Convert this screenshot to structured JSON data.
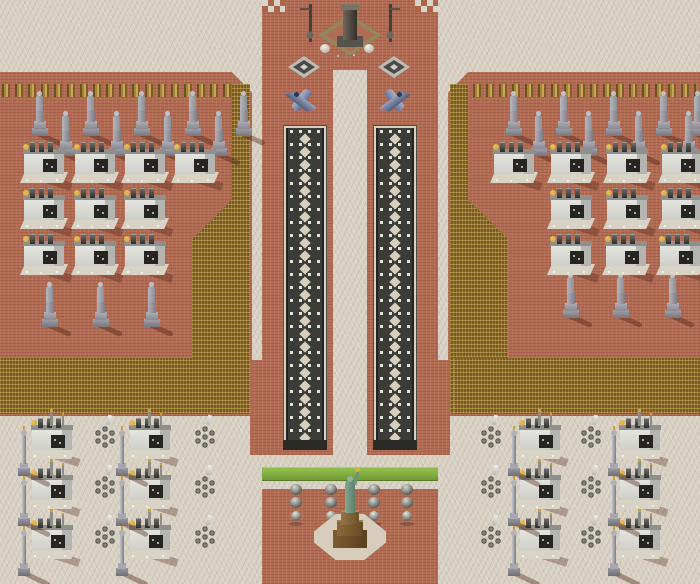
{
  "scene": {
    "kind": "isometric-rts-map",
    "width": 700,
    "height": 584
  },
  "palette": {
    "sand": "#d8d0c2",
    "brick": "#b06c55",
    "gold": "#8a6c2e",
    "track": "#3b3b37",
    "trackLight": "#e4e4de",
    "grass": "#6f9a34",
    "grassLight": "#95c050",
    "checkerRed": "#ad6449",
    "checkerWhite": "#d8d4cc",
    "statueGrey": "#9b99a1",
    "buildingWhite": "#e6e6e2",
    "libertyGreen": "#5a7e6a",
    "pedestalBrown": "#7c5c32",
    "jetBlue": "#667094",
    "goldDome": "#d2a032"
  },
  "terrain": [
    {
      "name": "sand-ground",
      "cls": "sand",
      "x": 0,
      "y": 0,
      "w": 700,
      "h": 584
    },
    {
      "name": "left-terrace",
      "cls": "red",
      "x": 0,
      "y": 72,
      "w": 252,
      "h": 344,
      "clip": "polygon(0 0, 92% 0, 100% 6%, 100% 100%, 0 100%)"
    },
    {
      "name": "right-terrace",
      "cls": "red",
      "x": 448,
      "y": 72,
      "w": 252,
      "h": 344,
      "clip": "polygon(8% 0, 100% 0, 100% 100%, 0 100%, 0 6%)"
    },
    {
      "name": "center-corridor",
      "cls": "red",
      "x": 262,
      "y": 0,
      "w": 176,
      "h": 455
    },
    {
      "name": "corridor-bridge-left",
      "cls": "red",
      "x": 250,
      "y": 360,
      "w": 12,
      "h": 95
    },
    {
      "name": "corridor-bridge-right",
      "cls": "red",
      "x": 438,
      "y": 360,
      "w": 12,
      "h": 95
    },
    {
      "name": "plaza-checker-left",
      "cls": "checker",
      "x": 262,
      "y": 0,
      "w": 23,
      "h": 12
    },
    {
      "name": "plaza-checker-right",
      "cls": "checker",
      "x": 415,
      "y": 0,
      "w": 23,
      "h": 12
    },
    {
      "name": "gold-row-left",
      "cls": "goldrow",
      "x": 2,
      "y": 84,
      "w": 240,
      "h": 13
    },
    {
      "name": "gold-band-left",
      "cls": "gold",
      "x": 192,
      "y": 84,
      "w": 58,
      "h": 330,
      "clip": "polygon(69% 0,100% 0,100% 100%,0 100%,0 47%,69% 35%)"
    },
    {
      "name": "gold-band-left-bottom",
      "cls": "gold",
      "x": 0,
      "y": 358,
      "w": 246,
      "h": 56
    },
    {
      "name": "gold-row-right",
      "cls": "goldrow",
      "x": 460,
      "y": 84,
      "w": 238,
      "h": 13
    },
    {
      "name": "gold-band-right",
      "cls": "gold",
      "x": 450,
      "y": 84,
      "w": 58,
      "h": 330,
      "clip": "polygon(0 0,31% 0,31% 35%,100% 47%,100% 100%,0 100%)"
    },
    {
      "name": "gold-band-right-bottom",
      "cls": "gold",
      "x": 454,
      "y": 358,
      "w": 246,
      "h": 56
    },
    {
      "name": "center-median",
      "cls": "sand",
      "x": 333,
      "y": 70,
      "w": 34,
      "h": 385
    },
    {
      "name": "track-left-bed",
      "cls": "trackout",
      "x": 283,
      "y": 125,
      "w": 44,
      "h": 325
    },
    {
      "name": "track-right-bed",
      "cls": "trackout",
      "x": 373,
      "y": 125,
      "w": 44,
      "h": 325
    },
    {
      "name": "track-cap-left",
      "cls": "cap",
      "x": 283,
      "y": 440,
      "w": 44,
      "h": 10
    },
    {
      "name": "track-cap-right",
      "cls": "cap",
      "x": 373,
      "y": 440,
      "w": 44,
      "h": 10
    },
    {
      "name": "grass-strip",
      "cls": "grass",
      "x": 262,
      "y": 467,
      "w": 176,
      "h": 14
    },
    {
      "name": "liberty-plaza",
      "cls": "red",
      "x": 262,
      "y": 489,
      "w": 176,
      "h": 95
    }
  ],
  "tracks": [
    {
      "x": 286,
      "y": 128,
      "w": 38,
      "h": 319
    },
    {
      "x": 376,
      "y": 128,
      "w": 38,
      "h": 319
    }
  ],
  "objects": {
    "statues": [
      [
        28,
        90
      ],
      [
        79,
        90
      ],
      [
        130,
        90
      ],
      [
        181,
        90
      ],
      [
        232,
        90
      ],
      [
        54,
        110
      ],
      [
        105,
        110
      ],
      [
        156,
        110
      ],
      [
        207,
        110
      ],
      [
        38,
        281
      ],
      [
        89,
        281
      ],
      [
        140,
        281
      ],
      [
        502,
        90
      ],
      [
        552,
        90
      ],
      [
        602,
        90
      ],
      [
        652,
        90
      ],
      [
        686,
        90
      ],
      [
        527,
        110
      ],
      [
        577,
        110
      ],
      [
        627,
        110
      ],
      [
        677,
        110
      ],
      [
        559,
        272
      ],
      [
        609,
        272
      ],
      [
        661,
        272
      ]
    ],
    "terrace_buildings": [
      [
        20,
        140
      ],
      [
        71,
        140
      ],
      [
        121,
        140
      ],
      [
        171,
        140
      ],
      [
        20,
        186
      ],
      [
        71,
        186
      ],
      [
        121,
        186
      ],
      [
        20,
        232
      ],
      [
        71,
        232
      ],
      [
        121,
        232
      ],
      [
        490,
        140
      ],
      [
        547,
        140
      ],
      [
        603,
        140
      ],
      [
        658,
        140
      ],
      [
        547,
        186
      ],
      [
        603,
        186
      ],
      [
        658,
        186
      ],
      [
        547,
        232
      ],
      [
        602,
        232
      ],
      [
        656,
        232
      ]
    ],
    "camp_buildings": [
      [
        28,
        416
      ],
      [
        126,
        416
      ],
      [
        28,
        466
      ],
      [
        126,
        466
      ],
      [
        28,
        516
      ],
      [
        126,
        516
      ],
      [
        516,
        416
      ],
      [
        616,
        416
      ],
      [
        516,
        466
      ],
      [
        616,
        466
      ],
      [
        516,
        516
      ],
      [
        616,
        516
      ]
    ],
    "obelisks": [
      [
        16,
        426
      ],
      [
        114,
        426
      ],
      [
        16,
        476
      ],
      [
        114,
        476
      ],
      [
        16,
        526
      ],
      [
        114,
        526
      ],
      [
        506,
        426
      ],
      [
        606,
        426
      ],
      [
        506,
        476
      ],
      [
        606,
        476
      ],
      [
        506,
        526
      ],
      [
        606,
        526
      ]
    ],
    "barrel_clusters": [
      [
        92,
        424
      ],
      [
        192,
        424
      ],
      [
        92,
        474
      ],
      [
        192,
        474
      ],
      [
        92,
        524
      ],
      [
        192,
        524
      ],
      [
        478,
        424
      ],
      [
        578,
        424
      ],
      [
        478,
        474
      ],
      [
        578,
        474
      ],
      [
        478,
        524
      ],
      [
        578,
        524
      ]
    ],
    "helipads": [
      [
        288,
        56
      ],
      [
        378,
        56
      ]
    ],
    "jets": {
      "left": [
        284,
        86
      ],
      "right": [
        378,
        86
      ]
    },
    "unit_groups": [
      [
        288,
        484
      ],
      [
        323,
        484
      ],
      [
        366,
        484
      ],
      [
        399,
        484
      ]
    ],
    "monument": [
      296,
      2
    ],
    "liberty": [
      314,
      466
    ]
  }
}
